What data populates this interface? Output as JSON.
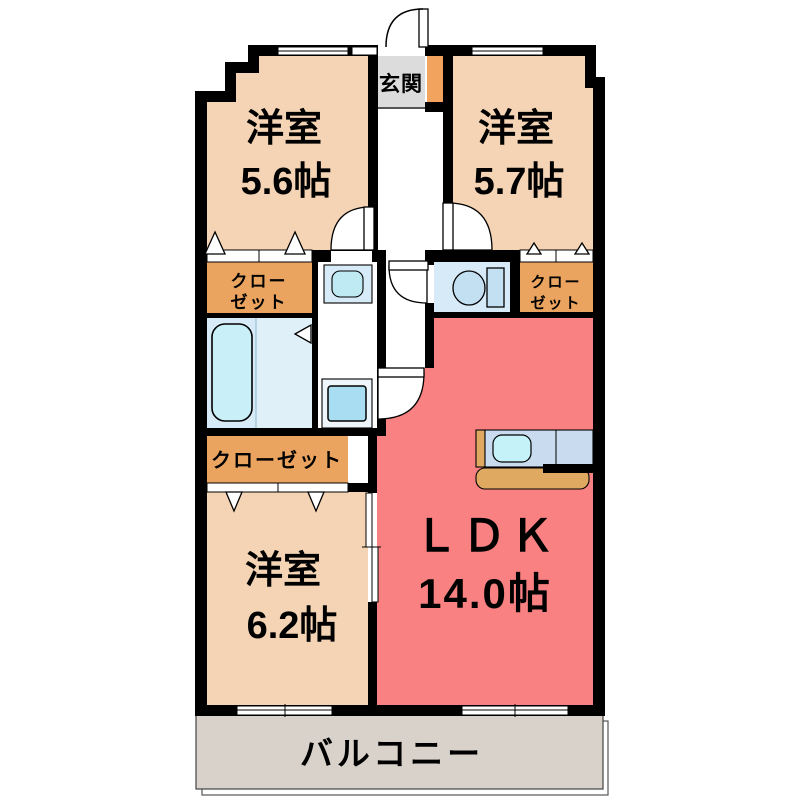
{
  "plan_title": "3LDK apartment floor plan",
  "labels": {
    "room56": {
      "name": "洋室",
      "size": "5.6帖"
    },
    "room57": {
      "name": "洋室",
      "size": "5.7帖"
    },
    "room62": {
      "name": "洋室",
      "size": "6.2帖"
    },
    "ldk": {
      "name": "ＬＤＫ",
      "size": "14.0帖"
    },
    "entrance": "玄関",
    "balcony": "バルコニー",
    "closet_left": {
      "line1": "クロー",
      "line2": "ゼット"
    },
    "closet_right": {
      "line1": "クロー",
      "line2": "ゼット"
    },
    "closet_bottom": "クローゼット"
  },
  "colors": {
    "wall": "#000000",
    "room": "#f4d4b4",
    "ldk": "#f98181",
    "closet": "#eaa45f",
    "shoebox": "#f2a45f",
    "entrance_floor": "#dcdcdc",
    "balcony": "#d8d2ca",
    "water_blue": "#d6ebf7",
    "bath_right": "#e0f0f9",
    "tub": "#c9eff8",
    "basin_inner": "#bfeaf4",
    "washer_inner": "#a9def2",
    "toilet_fixture": "#c3dff2",
    "counter_blue": "#c9dbee",
    "sink": "#c5f1f9",
    "counter_tan": "#dfa961"
  },
  "fixtures": [
    "bathtub",
    "washbasin",
    "washing-machine",
    "toilet",
    "kitchen-sink",
    "entrance-door",
    "hinged-doors",
    "folding-closet-doors",
    "sliding-door",
    "windows"
  ]
}
